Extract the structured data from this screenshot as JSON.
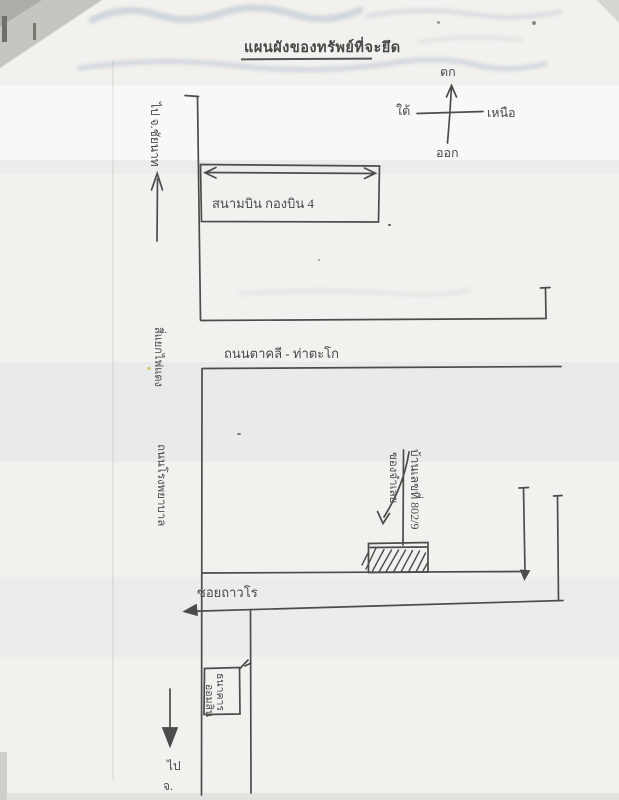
{
  "page": {
    "title": "แผนผังของทรัพย์ที่จะยึด"
  },
  "compass": {
    "top": "ตก",
    "left": "ใต้",
    "right": "เหนือ",
    "bottom": "ออก"
  },
  "labels": {
    "route_top": "ไป จ.ชัยนาท",
    "airport": "สนามบิน  กองบิน 4",
    "main_road": "ถนนตาคลี - ท่าตะโก",
    "intersection": "สี่แยกไฟแดง",
    "side_road": "ถนนโรงพยาบาล",
    "soi": "ซอยถาวโร",
    "property_line1": "บ้านเลขที่ 802/9",
    "property_line2": "ของจำเลย",
    "house_number": "802/9",
    "bank_line1": "ธนาคาร",
    "bank_line2": "ออมสิน",
    "route_bottom_line1": "ไป",
    "route_bottom_line2": "จ."
  },
  "colors": {
    "ink": "#3e3e3e",
    "paper": "#f2f1ed",
    "ghost_ink": "#a9b6cc"
  }
}
